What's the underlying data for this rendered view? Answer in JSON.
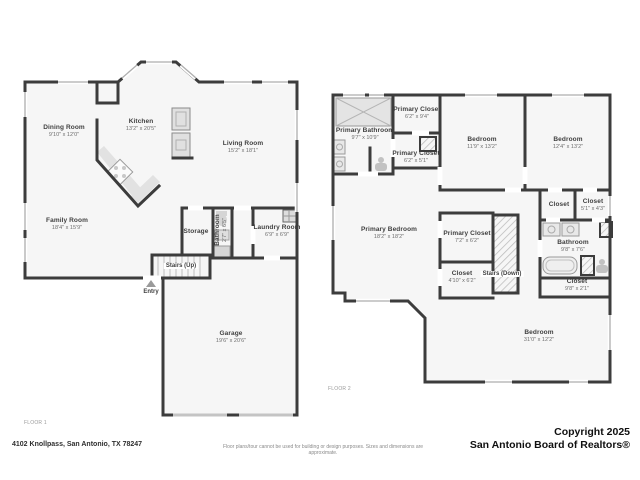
{
  "floor1": {
    "label": "FLOOR 1",
    "stairs_up_label": "Stairs (Up)",
    "entry_label": "Entry",
    "rooms": [
      {
        "name": "Dining Room",
        "dims": "9'10\" x 12'0\""
      },
      {
        "name": "Kitchen",
        "dims": "13'2\" x 20'5\""
      },
      {
        "name": "Living Room",
        "dims": "15'2\" x 18'1\""
      },
      {
        "name": "Family Room",
        "dims": "18'4\" x 15'9\""
      },
      {
        "name": "Storage",
        "dims": ""
      },
      {
        "name": "Bathroom",
        "dims": "2'7\" x 6'5\""
      },
      {
        "name": "Laundry Room",
        "dims": "6'9\" x 6'9\""
      },
      {
        "name": "Garage",
        "dims": "19'6\" x 20'6\""
      }
    ]
  },
  "floor2": {
    "label": "FLOOR 2",
    "stairs_down_label": "Stairs (Down)",
    "rooms": [
      {
        "name": "Primary Bathroom",
        "dims": "9'7\" x 10'9\""
      },
      {
        "name": "Primary Closet",
        "dims": "6'2\" x 9'4\""
      },
      {
        "name": "Primary Closet",
        "dims": "6'2\" x 5'1\""
      },
      {
        "name": "Bedroom",
        "dims": "11'9\" x 13'2\""
      },
      {
        "name": "Bedroom",
        "dims": "12'4\" x 13'2\""
      },
      {
        "name": "Closet",
        "dims": ""
      },
      {
        "name": "Closet",
        "dims": "5'1\" x 4'3\""
      },
      {
        "name": "Bathroom",
        "dims": "9'8\" x 7'6\""
      },
      {
        "name": "Primary Bedroom",
        "dims": "18'2\" x 18'2\""
      },
      {
        "name": "Primary Closet",
        "dims": "7'2\" x 6'2\""
      },
      {
        "name": "Closet",
        "dims": "4'10\" x 6'2\""
      },
      {
        "name": "Closet",
        "dims": "9'8\" x 2'1\""
      },
      {
        "name": "Bedroom",
        "dims": "31'0\" x 12'2\""
      }
    ]
  },
  "footer": {
    "address": "4102 Knollpass, San Antonio, TX 78247",
    "disclaimer": "Floor plans/tour cannot be used for building or design purposes. Sizes and dimensions are approximate.",
    "copyright_line1": "Copyright 2025",
    "copyright_line2": "San Antonio Board of Realtors®"
  }
}
